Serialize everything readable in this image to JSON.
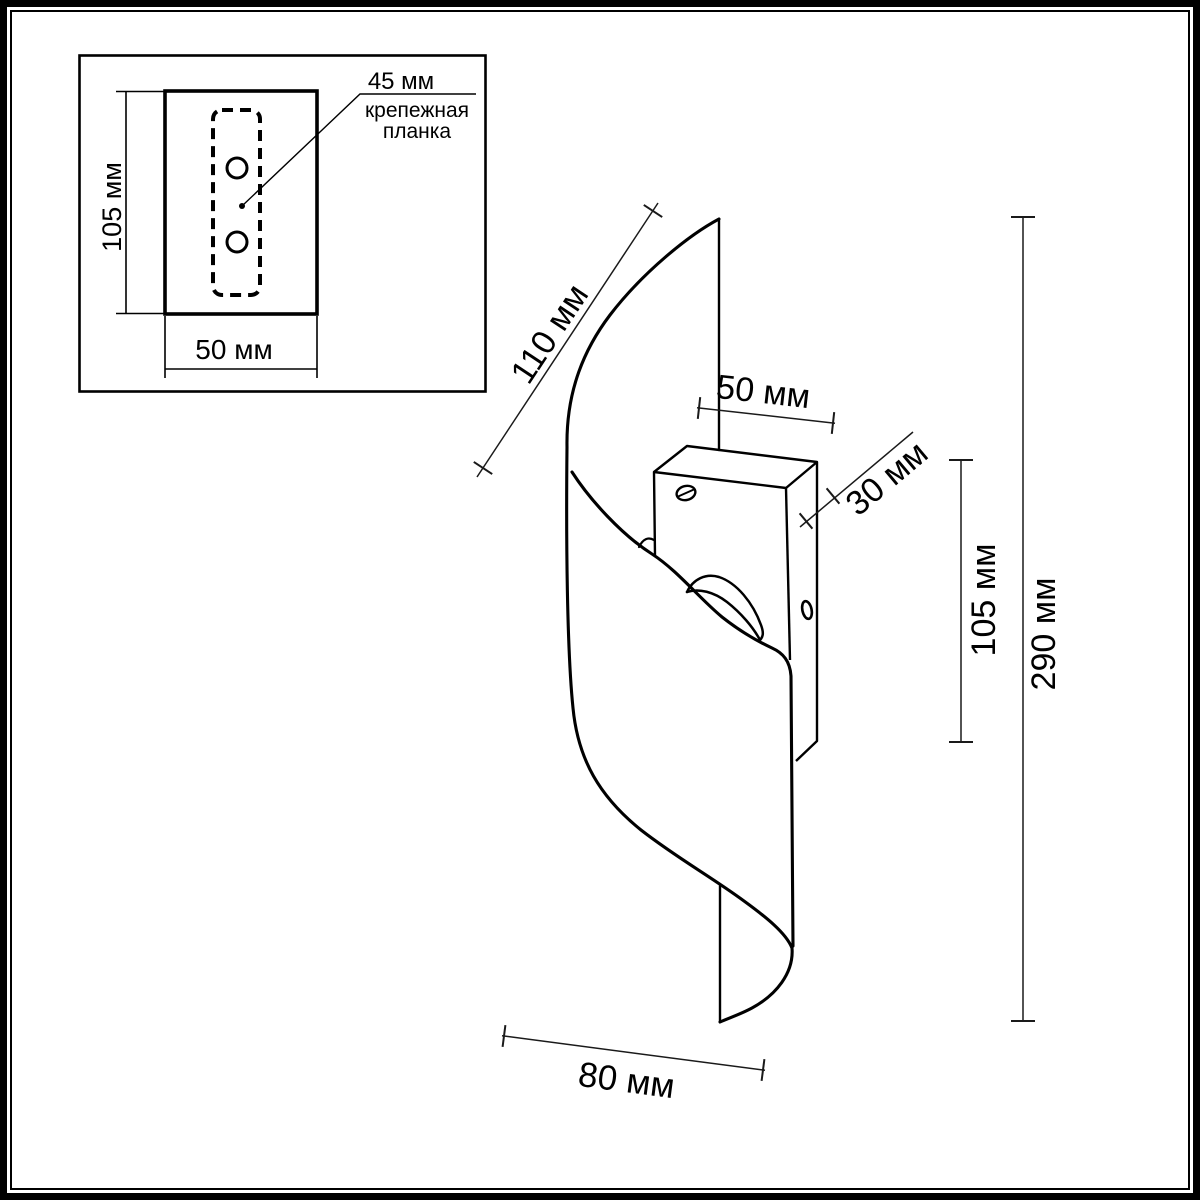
{
  "drawing": {
    "background": "#ffffff",
    "line_color": "#000000",
    "inset": {
      "plate_height_label": "105 мм",
      "plate_width_label": "50 мм",
      "bracket_width_label": "45 мм",
      "bracket_caption_line1": "крепежная",
      "bracket_caption_line2": "планка"
    },
    "main": {
      "shade_edge_label": "110 мм",
      "bracket_width_label": "50 мм",
      "bracket_depth_label": "30 мм",
      "bracket_height_label": "105 мм",
      "total_height_label": "290 мм",
      "base_width_label": "80 мм"
    }
  }
}
